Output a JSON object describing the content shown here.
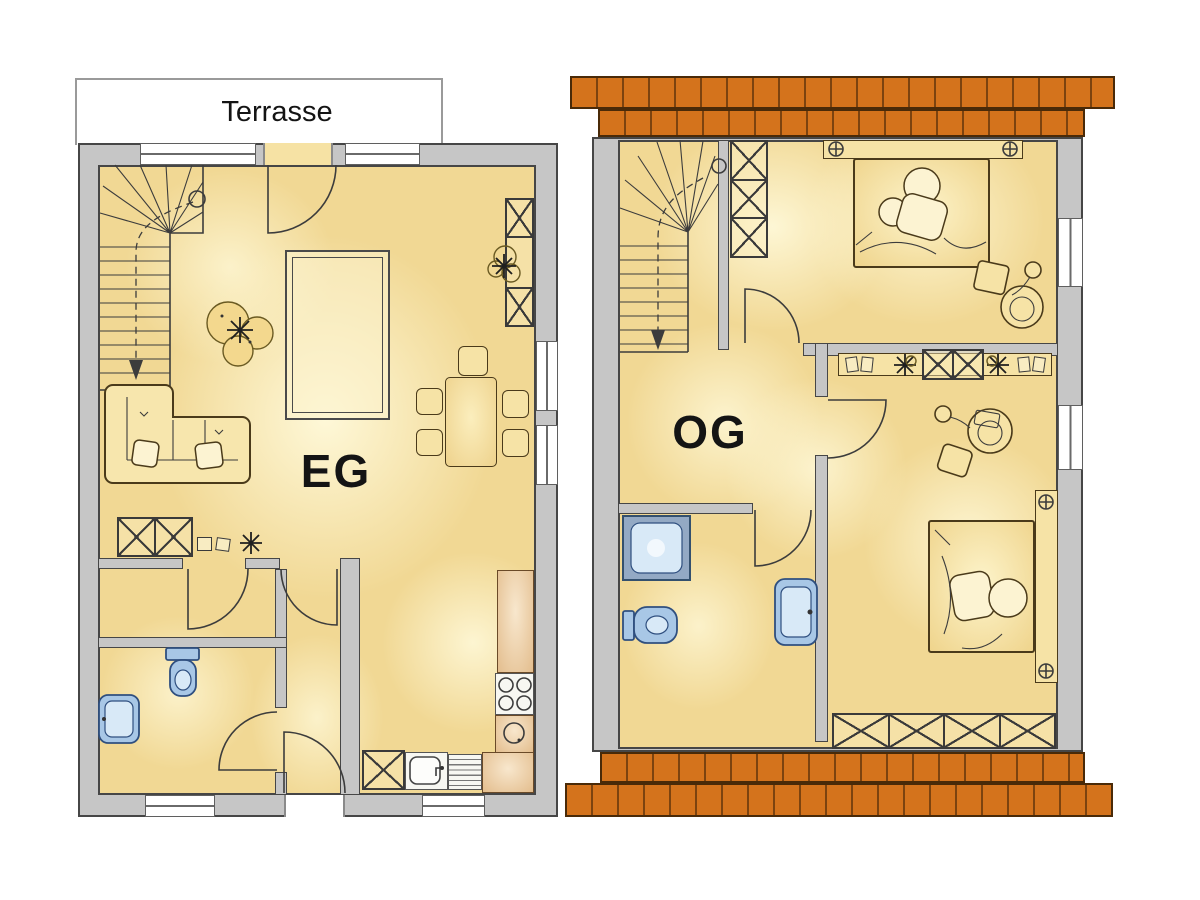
{
  "labels": {
    "terrace": "Terrasse",
    "ground_floor": "EG",
    "upper_floor": "OG"
  },
  "colors": {
    "wall_fill": "#c6c6c6",
    "wall_line": "#464646",
    "floor_base": "#f1d894",
    "roof_fill": "#d4731c",
    "roof_line": "#7c430f",
    "furniture_fill": "#f6e3a6",
    "furniture_line": "#4a3a1a",
    "counter_fill": "#e3bd8d",
    "counter_light": "#f8e7cd",
    "fixture_fill": "#a8c7e6",
    "fixture_line": "#2f4f7f",
    "window_white": "#ffffff",
    "label_color": "#141414"
  }
}
